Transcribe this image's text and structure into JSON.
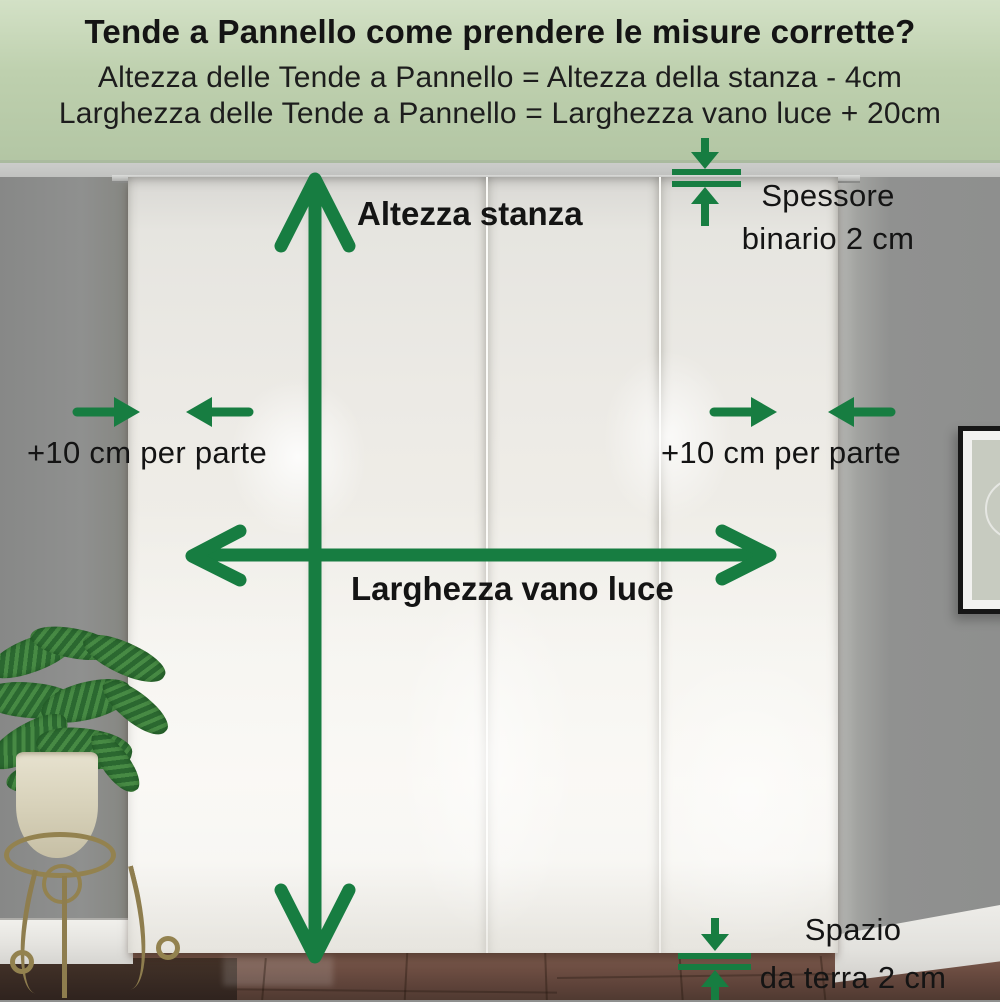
{
  "header": {
    "title": "Tende a Pannello come prendere le misure corrette?",
    "formula_height": "Altezza delle Tende a Pannello = Altezza della stanza - 4cm",
    "formula_width": "Larghezza delle Tende a Pannello = Larghezza vano luce + 20cm"
  },
  "annotations": {
    "room_height_label": "Altezza stanza",
    "window_width_label": "Larghezza vano luce",
    "left_side_margin_label": "+10 cm per parte",
    "right_side_margin_label": "+10 cm per parte",
    "rail_thickness_label": {
      "line1": "Spessore",
      "line2": "binario 2 cm"
    },
    "floor_gap_label": {
      "line1": "Spazio",
      "line2": "da terra 2 cm"
    }
  },
  "colors": {
    "accent_green": "#177d41",
    "header_background": "#bed0ae",
    "header_text": "#141414",
    "label_text": "#141414",
    "wall_gray": "#8f908f",
    "curtain_white": "#f1efe9",
    "floor_brown": "#6b4c41"
  }
}
